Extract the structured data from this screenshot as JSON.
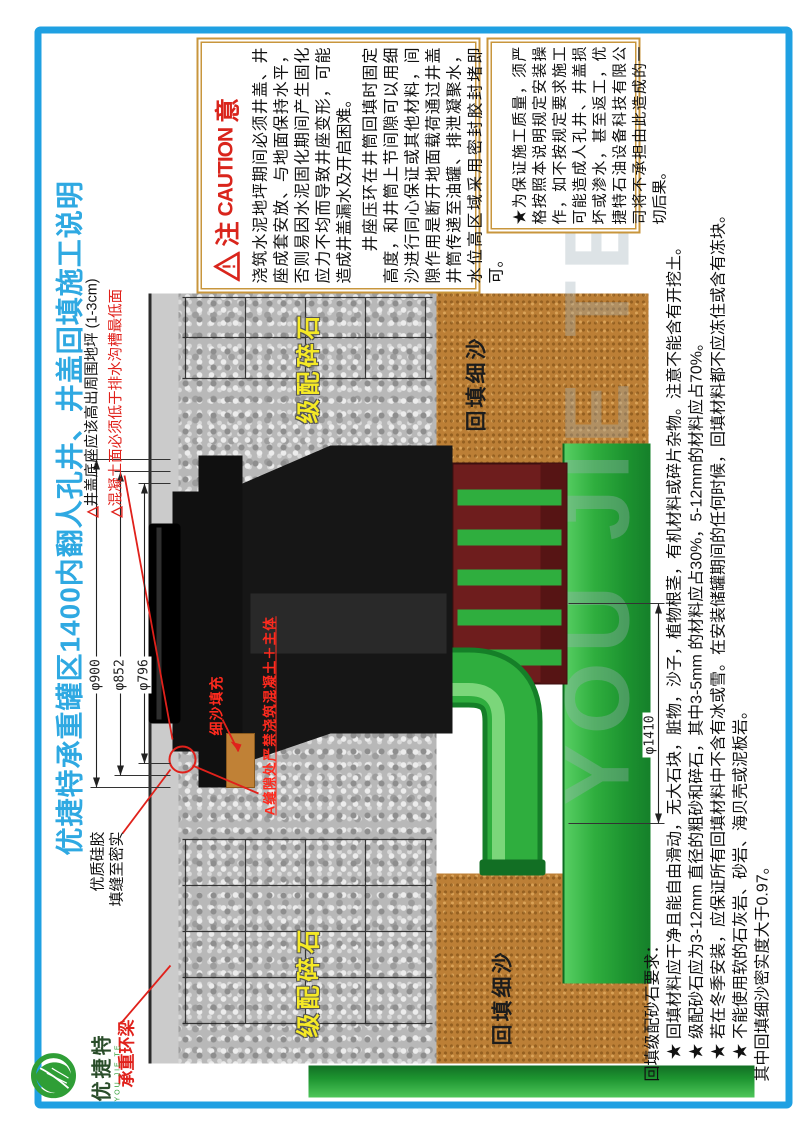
{
  "title": "优捷特承重罐区1400内翻人孔井、井盖回填施工说明",
  "logo": {
    "name": "优捷特",
    "romanized": "YOU JIE TE"
  },
  "watermark": "YOU JIE TE",
  "caution": {
    "prefix": "注",
    "en": "CAUTION",
    "suffix": "意",
    "para1": "浇筑水泥地坪期间必须井盖、井座成套安放、与地面保持水平，否则易因水泥固化期间产生固化应力不均而导致井座变形，可能造成井盖漏水及开启困难。",
    "para2": "井座压环在井筒回填时固定高度，和井筒上节间隙可以用细沙进行同心保证或其他材料，间隙作用是断开地面载荷通过井盖井筒传递至油罐、排泄凝聚水，水位高区域采用密封胶封堵即可。",
    "para3": "★为保证施工质量，须严格按照本说明规定安装操作，如不按规定要求施工可能造成人孔井、井盖损坏或渗水，甚至返工，优捷特石油设备科技有限公司将不承担由此造成的一切后果。"
  },
  "notes": {
    "triangle": "△",
    "seat_level": "井盖底座应该高出周围地坪 (1-3cm)",
    "concrete_level": "混凝土面必须低于排水沟槽最低面",
    "silicone_1": "优质硅胶",
    "silicone_2": "填缝至密实",
    "ring_beam": "承重环梁",
    "sand_fill": "细沙填充",
    "gap_warning": "A缝隙处严禁浇筑混凝土＋主体"
  },
  "layers": {
    "graded_gravel": "级配碎石",
    "backfill_sand": "回填细沙"
  },
  "dims": {
    "d900": "φ900",
    "d852": "φ852",
    "d796": "φ796",
    "d1410": "φ1410"
  },
  "backfill_spec": {
    "heading": "回填级配砂石要求：",
    "items": [
      "★ 回填材料应干净且能自由滑动，无大石块，脏物，沙子，植物根茎，有机材料或碎片杂物。注意不能含有开挖土。",
      "★ 级配砂石应为3-12mm 直径的粗砂和碎石，其中3-5mm 的材料应占30%，5-12mm的材料应占70%。",
      "★ 若在冬季安装，应保证所有回填材料中不含有冰或雪。在安装储罐期间的任何时候，回填材料都不应冻住或含有冻块。",
      "★ 不能使用软的石灰岩、砂岩、海贝壳或泥板岩。"
    ],
    "note": "其中回填细沙密实度大于0.97。"
  },
  "colors": {
    "frame": "#1FA0E2",
    "title": "#2FA9E2",
    "caution_red": "#D9251C",
    "annotation_red": "#E0211B",
    "gravel_label_yellow": "#F5E926",
    "pipe_green": "#2FAE3E",
    "sump_maroon": "#6E1D1D"
  }
}
